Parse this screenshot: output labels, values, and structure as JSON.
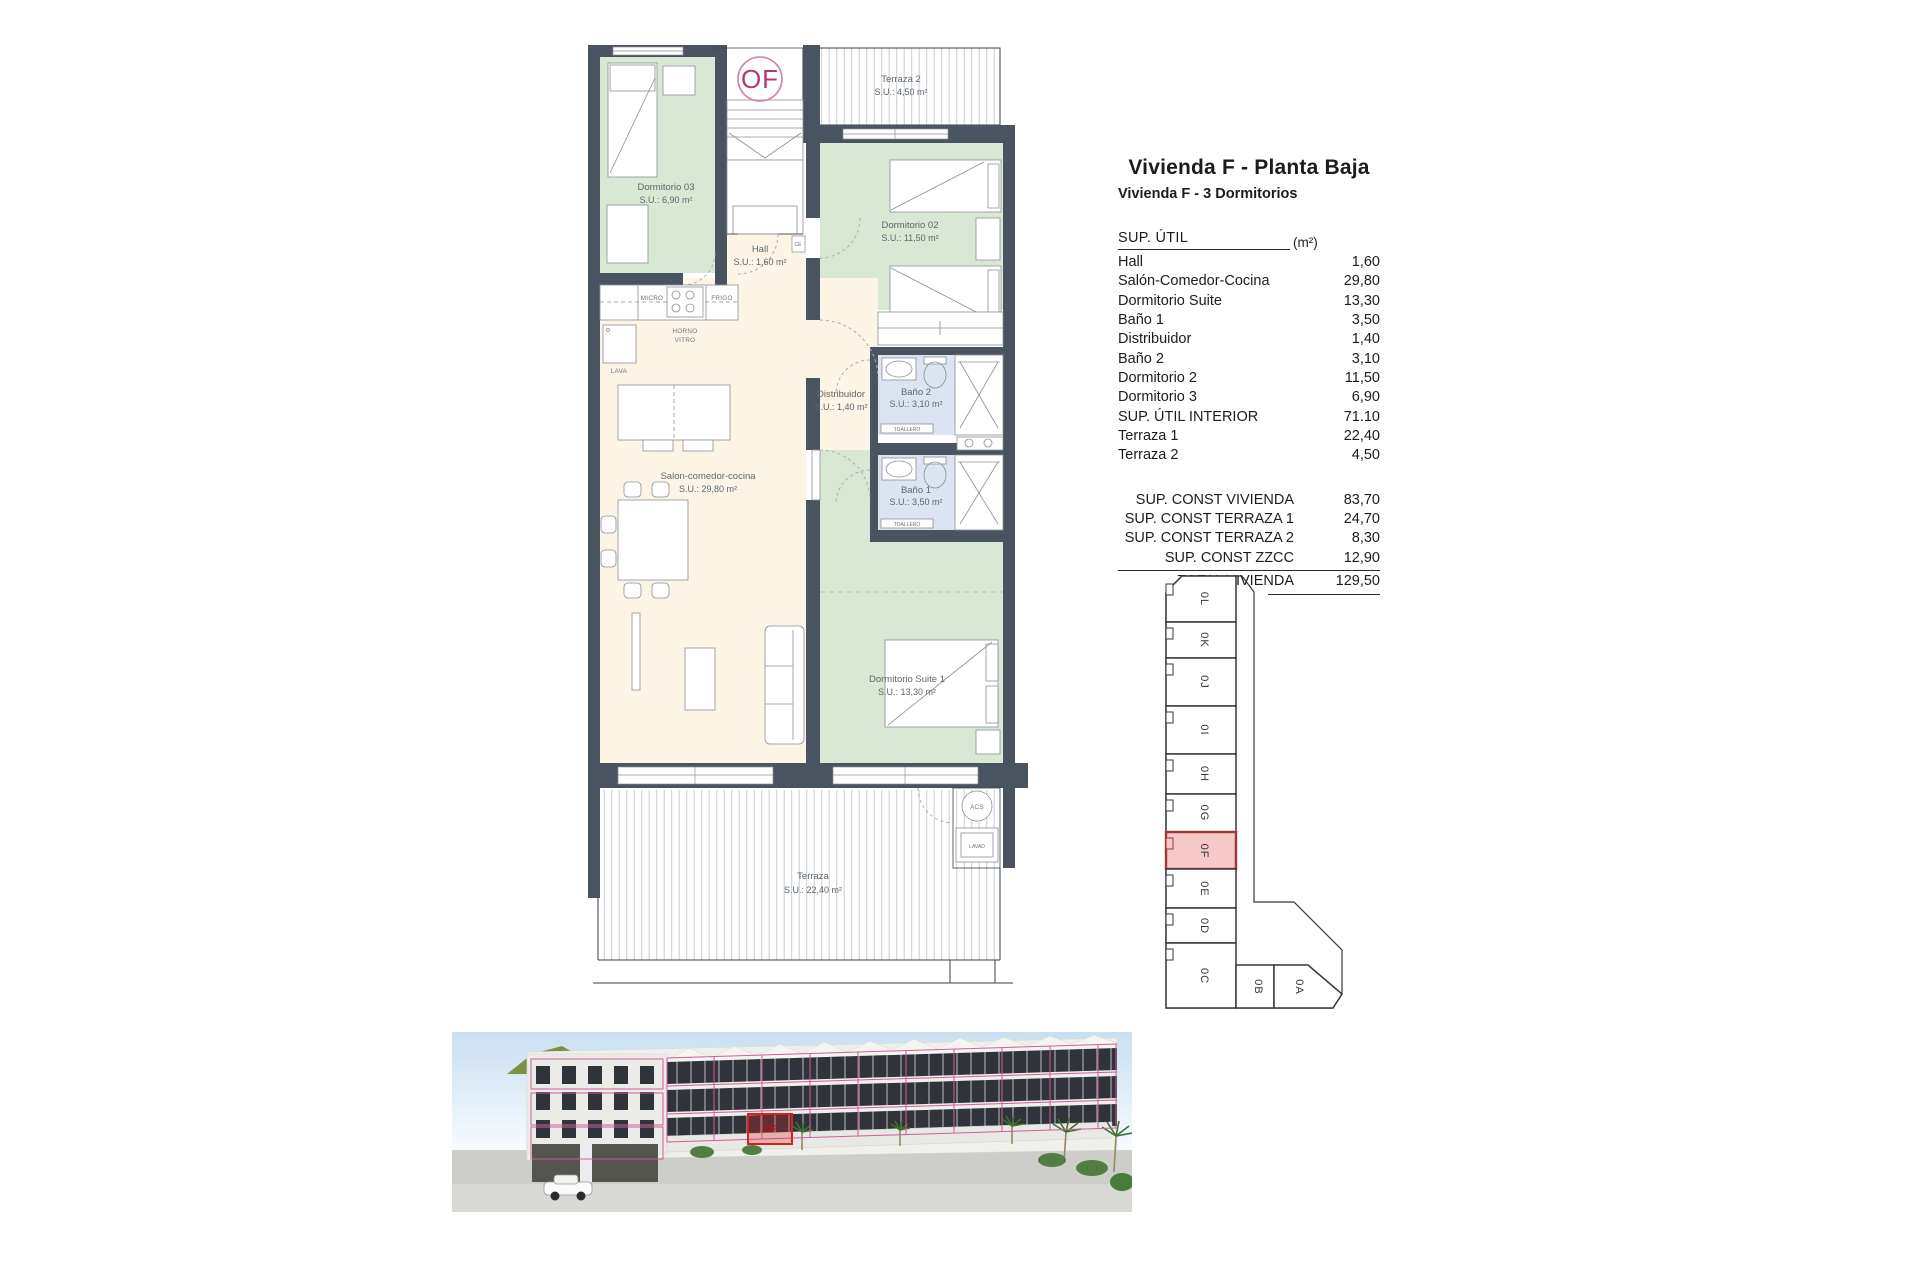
{
  "header": {
    "title": "Vivienda F - Planta Baja",
    "subtitle": "Vivienda F - 3 Dormitorios"
  },
  "table": {
    "header": {
      "label": "SUP. ÚTIL",
      "unit": "(m²)"
    },
    "rows": [
      {
        "label": "Hall",
        "value": "1,60"
      },
      {
        "label": "Salón-Comedor-Cocina",
        "value": "29,80"
      },
      {
        "label": "Dormitorio Suite",
        "value": "13,30"
      },
      {
        "label": "Baño 1",
        "value": "3,50"
      },
      {
        "label": "Distribuidor",
        "value": "1,40"
      },
      {
        "label": "Baño 2",
        "value": "3,10"
      },
      {
        "label": "Dormitorio 2",
        "value": "11,50"
      },
      {
        "label": "Dormitorio 3",
        "value": "6,90"
      },
      {
        "label": "SUP. ÚTIL INTERIOR",
        "value": "71.10"
      },
      {
        "label": "Terraza 1",
        "value": "22,40"
      },
      {
        "label": "Terraza 2",
        "value": "4,50"
      }
    ],
    "summary": [
      {
        "label": "SUP. CONST VIVIENDA",
        "value": "83,70"
      },
      {
        "label": "SUP. CONST TERRAZA 1",
        "value": "24,70"
      },
      {
        "label": "SUP. CONST TERRAZA 2",
        "value": "8,30"
      },
      {
        "label": "SUP. CONST ZZCC",
        "value": "12,90"
      }
    ],
    "total": {
      "label": "TOTAL VIVIENDA",
      "value": "129,50"
    }
  },
  "plan": {
    "badge": "OF",
    "rooms": {
      "terraza2": {
        "name": "Terraza 2",
        "area": "S.U.: 4,50 m²"
      },
      "dorm3": {
        "name": "Dormitorio 03",
        "area": "S.U.: 6,90 m²"
      },
      "dorm2": {
        "name": "Dormitorio 02",
        "area": "S.U.: 11,50 m²"
      },
      "hall": {
        "name": "Hall",
        "area": "S.U.: 1,60 m²"
      },
      "salon": {
        "name": "Salon-comedor-cocina",
        "area": "S.U.: 29,80 m²"
      },
      "distribuidor": {
        "name": "Distribuidor",
        "area": "S.U.: 1,40 m²"
      },
      "bano2": {
        "name": "Baño 2",
        "area": "S.U.: 3,10 m²"
      },
      "bano1": {
        "name": "Baño 1",
        "area": "S.U.: 3,50 m²"
      },
      "suite": {
        "name": "Dormitorio Suite 1",
        "area": "S.U.: 13,30 m²"
      },
      "terraza1": {
        "name": "Terraza",
        "area": "S.U.: 22,40 m²"
      }
    },
    "fixtures": {
      "micro": "MICRO",
      "frigo": "FRIGO",
      "horno": "HORNO",
      "vitro": "VITRO",
      "lava": "LAVA",
      "toallero": "TOALLERO",
      "acs": "ACS",
      "lavad": "LAVAD",
      "ce": "CE"
    }
  },
  "keyplan": {
    "highlighted_unit": "0F",
    "units": [
      "0L",
      "0K",
      "0J",
      "0I",
      "0H",
      "0G",
      "0F",
      "0E",
      "0D",
      "0C",
      "0B",
      "0A"
    ]
  },
  "photo": {
    "label": "OF"
  },
  "colors": {
    "wall": "#4a5460",
    "room_green": "#d8e8d5",
    "room_cream": "#fcf5e6",
    "room_blue": "#dce4f1",
    "highlight_pink": "#f6c8c8",
    "highlight_border": "#a03737",
    "badge_magenta": "#b03a78",
    "overlay_pink": "#cb5f9e",
    "overlay_red": "#d91f1f"
  }
}
